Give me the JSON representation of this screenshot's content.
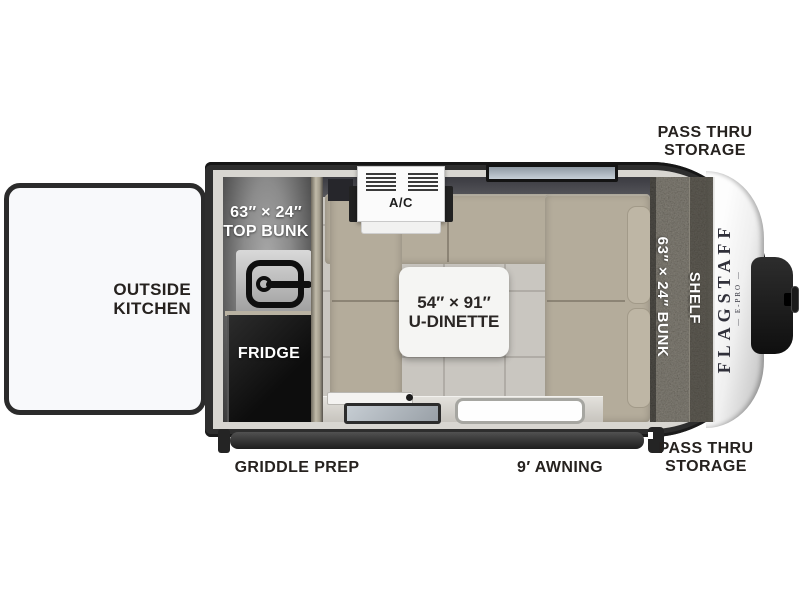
{
  "floorplan": {
    "brand": {
      "name": "FLAGSTAFF",
      "model": "E-PRO",
      "model_display": "— E-PRO —"
    },
    "labels": {
      "pass_thru_top_1": "PASS THRU",
      "pass_thru_top_2": "STORAGE",
      "outside_kitchen_1": "OUTSIDE",
      "outside_kitchen_2": "KITCHEN",
      "top_bunk_1": "63″ × 24″",
      "top_bunk_2": "TOP BUNK",
      "fridge": "FRIDGE",
      "ac": "A/C",
      "u_dinette_1": "54″ × 91″",
      "u_dinette_2": "U-DINETTE",
      "bunk": "63″ × 24″ BUNK",
      "shelf": "SHELF",
      "griddle_prep": "GRIDDLE PREP",
      "awning": "9′ AWNING",
      "pass_thru_bottom_1": "PASS THRU",
      "pass_thru_bottom_2": "STORAGE"
    },
    "colors": {
      "wall": "#2e2e2e",
      "lining": "#d8d6d1",
      "cushion": "#b4ac9b",
      "floor": "#c9c6c0",
      "bunk_texture": "#7e7769",
      "front_cap": "#f5f5f5",
      "label_text": "#26221f"
    }
  }
}
